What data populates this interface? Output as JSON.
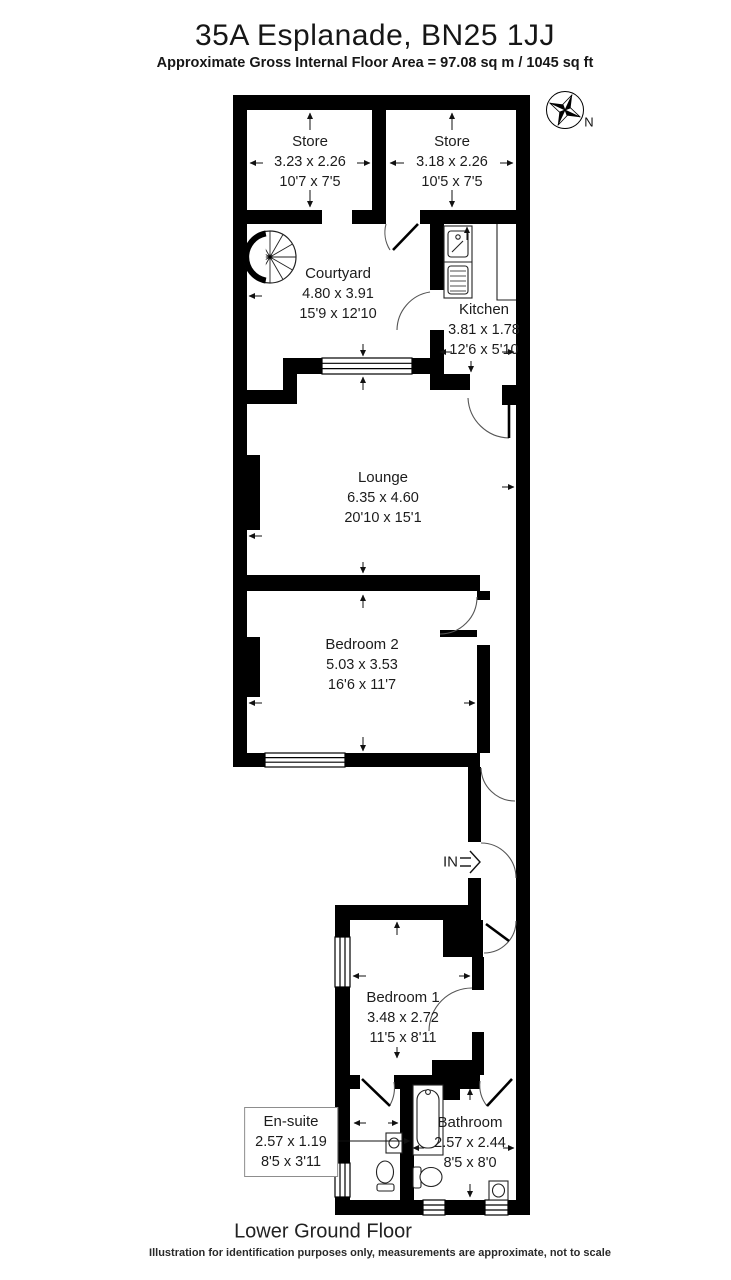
{
  "header": {
    "title": "35A Esplanade, BN25 1JJ",
    "subtitle": "Approximate Gross Internal Floor Area = 97.08 sq m / 1045 sq ft"
  },
  "rooms": {
    "store1": {
      "name": "Store",
      "metric": "3.23 x 2.26",
      "imperial": "10'7 x 7'5"
    },
    "store2": {
      "name": "Store",
      "metric": "3.18 x 2.26",
      "imperial": "10'5 x 7'5"
    },
    "courtyard": {
      "name": "Courtyard",
      "metric": "4.80 x 3.91",
      "imperial": "15'9 x 12'10"
    },
    "kitchen": {
      "name": "Kitchen",
      "metric": "3.81 x 1.78",
      "imperial": "12'6 x 5'10"
    },
    "lounge": {
      "name": "Lounge",
      "metric": "6.35 x 4.60",
      "imperial": "20'10 x 15'1"
    },
    "bedroom2": {
      "name": "Bedroom 2",
      "metric": "5.03 x 3.53",
      "imperial": "16'6 x 11'7"
    },
    "bedroom1": {
      "name": "Bedroom 1",
      "metric": "3.48 x 2.72",
      "imperial": "11'5 x 8'11"
    },
    "ensuite": {
      "name": "En-suite",
      "metric": "2.57 x 1.19",
      "imperial": "8'5 x 3'11"
    },
    "bathroom": {
      "name": "Bathroom",
      "metric": "2.57 x 2.44",
      "imperial": "8'5 x 8'0"
    }
  },
  "annotations": {
    "entrance": "IN",
    "north": "N"
  },
  "footer": {
    "floor_label": "Lower Ground Floor",
    "disclaimer": "Illustration for identification purposes only, measurements are approximate, not to scale"
  },
  "colors": {
    "wall": "#000000",
    "background": "#ffffff",
    "door_arc": "#555555"
  }
}
